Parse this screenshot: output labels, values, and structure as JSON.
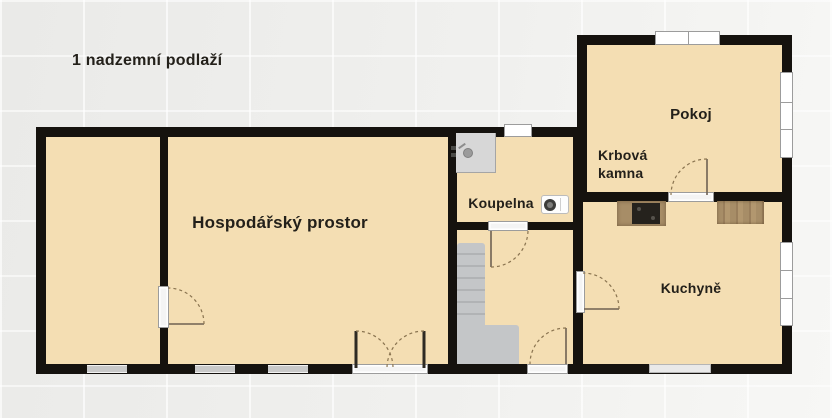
{
  "title": "1 nadzemní podlaží",
  "rooms": {
    "hospodarsky_prostor": {
      "label": "Hospodářský prostor"
    },
    "koupelna": {
      "label": "Koupelna"
    },
    "pokoj": {
      "label": "Pokoj"
    },
    "kuchyne": {
      "label": "Kuchyně"
    },
    "krbova_kamna": {
      "line1": "Krbová",
      "line2": "kamna"
    }
  },
  "icons": {
    "shower": "shower-icon",
    "washing_machine": "washing-machine-icon",
    "stove": "stove-icon",
    "countertop": "countertop-icon",
    "stairs": "stairs-icon",
    "window": "window-icon",
    "door_swing": "door-swing-icon"
  },
  "colors": {
    "wall": "#15120e",
    "room_fill": "#f4deb3",
    "bg_left": "#eaeae8",
    "bg_right": "#f7f7f5",
    "text": "#23201a",
    "stairs": "#c4c6c8",
    "stairs_tread": "#b1b3b5",
    "shower": "#d7d7d7",
    "door_arc": "#8a7450",
    "window_frame": "#9c9c9c",
    "wood": "#a78d67",
    "stove_top": "#25221d"
  }
}
